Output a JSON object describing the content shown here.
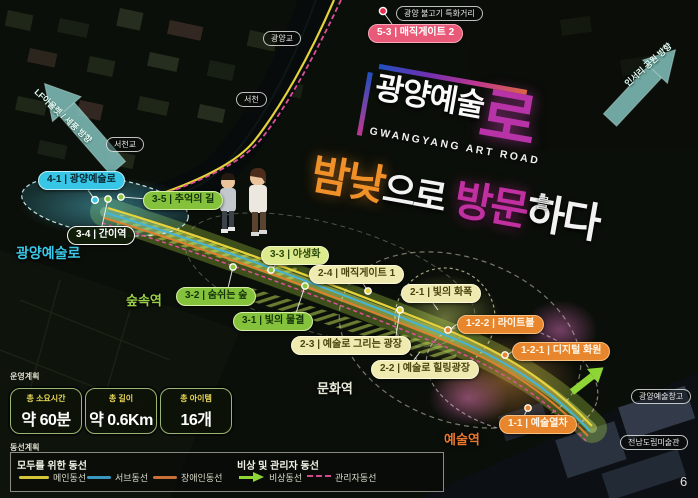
{
  "page": {
    "slide_number": "6"
  },
  "header": {
    "title": "공간구성계획",
    "subtitle": "공간별 동선계획"
  },
  "direction_arrows": {
    "top_left": "LF아울렛 / 세풍 방향",
    "top_right": "인서리 공원 방향"
  },
  "art_title": {
    "main": "광양예술",
    "main_big_char": "로",
    "english": "GWANGYANG ART ROAD",
    "particle": "를",
    "tagline": [
      {
        "text": "밤낮",
        "color": "#f09028"
      },
      {
        "text": "으로",
        "color": "#f2f2f2"
      },
      {
        "text": " 방문",
        "color": "#c030a0"
      },
      {
        "text": "하다",
        "color": "#f2f2f2"
      }
    ]
  },
  "poi_bubbles": [
    {
      "label": "5-3 | 매직게이트 2",
      "style": "pink"
    },
    {
      "label": "4-1 | 광양예술로",
      "style": "cyan"
    },
    {
      "label": "3-5 | 추억의 길",
      "style": "green"
    },
    {
      "label": "3-4 | 간이역",
      "style": "dark"
    },
    {
      "label": "3-3 | 야생화",
      "style": "lime"
    },
    {
      "label": "2-4 | 매직게이트 1",
      "style": "paleyellow"
    },
    {
      "label": "3-2 | 숨쉬는 숲",
      "style": "green"
    },
    {
      "label": "3-1 | 빛의 물결",
      "style": "green"
    },
    {
      "label": "2-3 | 예술로 그리는 광장",
      "style": "paleyellow"
    },
    {
      "label": "2-2 | 예술로 힐링광장",
      "style": "paleyellow"
    },
    {
      "label": "2-1 | 빛의 화폭",
      "style": "paleyellow"
    },
    {
      "label": "1-2-2 | 라이트볼",
      "style": "orange"
    },
    {
      "label": "1-2-1 | 디지털 화원",
      "style": "orange"
    },
    {
      "label": "1-1 | 예술열차",
      "style": "orange"
    }
  ],
  "place_bubbles": {
    "gwangyang_bridge": "광양교",
    "seocheon": "서천",
    "seocheon_bridge": "서천교",
    "bulgogi_street": "광양 불고기 특화거리",
    "art_warehouse": "광양예술창고",
    "art_museum": "전남도립미술관"
  },
  "zone_labels": {
    "art_road": "광양예술로",
    "forest_station": "숲속역",
    "culture_station": "문화역",
    "art_station": "예술역"
  },
  "operation_plan": {
    "section_label": "운영계획",
    "stats": [
      {
        "label": "총 소요시간",
        "value": "약 60분"
      },
      {
        "label": "총 길이",
        "value": "약 0.6Km"
      },
      {
        "label": "총 아이템",
        "value": "16개"
      }
    ]
  },
  "route_legend": {
    "section_label": "동선계획",
    "group_all": {
      "title": "모두를 위한 동선",
      "items": [
        {
          "label": "메인동선",
          "color": "#d4c438"
        },
        {
          "label": "서브동선",
          "color": "#3898c0"
        },
        {
          "label": "장애인동선",
          "color": "#c87038"
        }
      ]
    },
    "group_emergency": {
      "title": "비상 및 관리자 동선",
      "items": [
        {
          "label": "비상동선",
          "color": "#8ed636"
        },
        {
          "label": "관리자동선",
          "color": "#d4488c"
        }
      ]
    }
  },
  "colors": {
    "accent_cyan": "#38c6e6",
    "accent_green": "#85c23c",
    "accent_paleyellow": "#efeab0",
    "accent_orange": "#e8862e",
    "accent_pink": "#e85a78",
    "accent_magenta": "#b832a8"
  }
}
